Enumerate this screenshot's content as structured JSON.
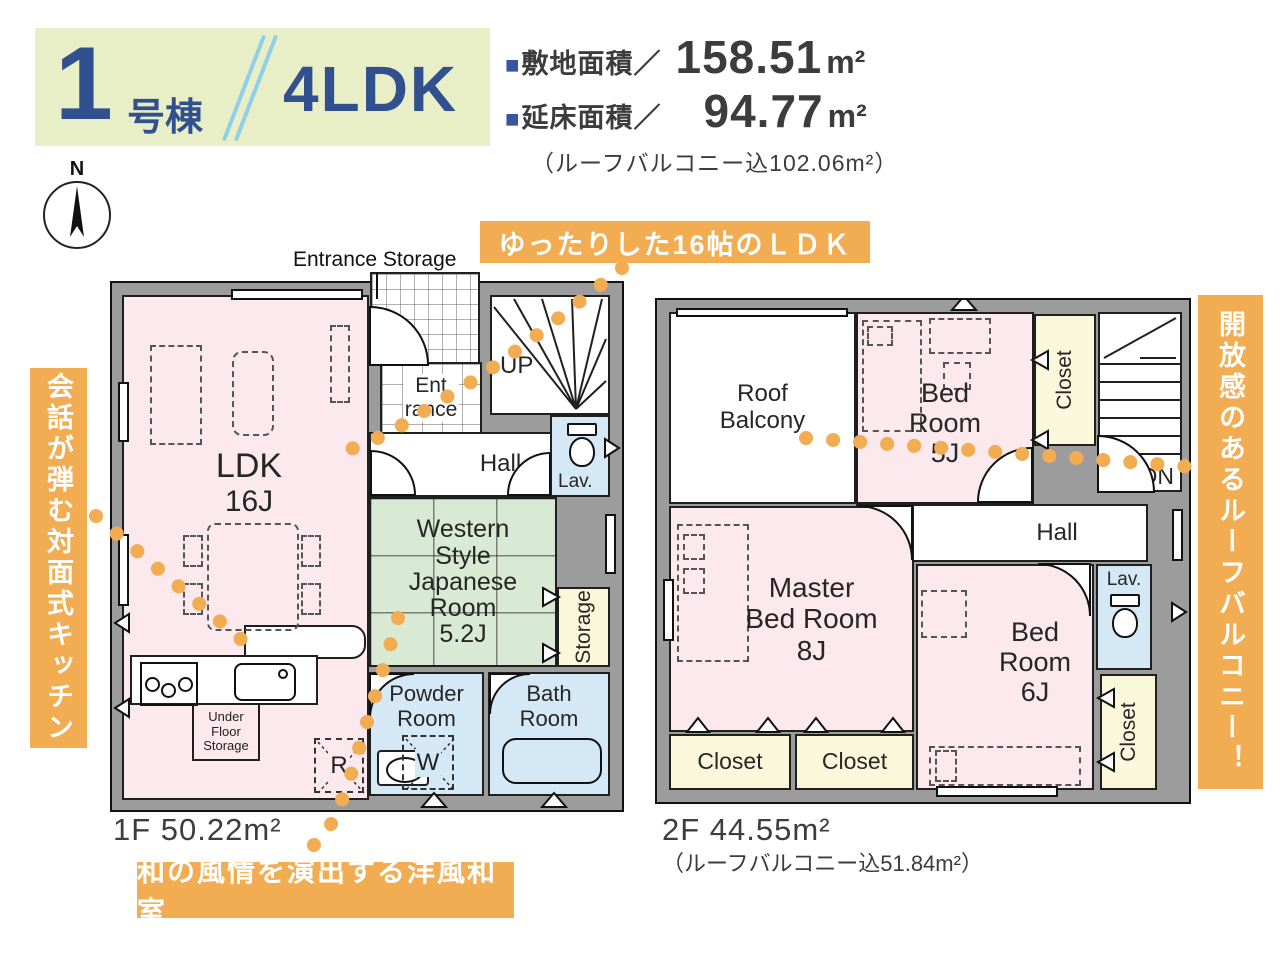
{
  "header": {
    "building_number": "1",
    "building_suffix": "号棟",
    "plan_type": "4LDK",
    "bullet": "■",
    "site_area_label": "敷地面積／",
    "site_area_value": "158.51",
    "floor_area_label": "延床面積／",
    "floor_area_value": "94.77",
    "area_unit": "m²",
    "balcony_note": "（ルーフバルコニー込102.06m²）"
  },
  "compass": {
    "north_label": "N"
  },
  "callouts": {
    "ldk": "ゆったりした16帖のＬＤＫ",
    "kitchen": "会話が弾む対面式キッチン",
    "roof_balcony": "開放感のあるルーフバルコニー！",
    "japanese_room": "和の風情を演出する洋風和室"
  },
  "floor1": {
    "caption": "1F 50.22m²",
    "entrance_storage_label": "Entrance Storage",
    "rooms": {
      "ldk": {
        "name": "LDK",
        "size": "16J"
      },
      "entrance": {
        "line1": "Ent",
        "line2": "rance"
      },
      "stairs": "UP",
      "hall": "Hall",
      "lavatory": "Lav.",
      "japanese_room": {
        "line1": "Western",
        "line2": "Style",
        "line3": "Japanese",
        "line4": "Room",
        "size": "5.2J"
      },
      "storage": "Storage",
      "powder_room": {
        "line1": "Powder",
        "line2": "Room"
      },
      "bath_room": {
        "line1": "Bath",
        "line2": "Room"
      },
      "under_floor_storage": {
        "line1": "Under",
        "line2": "Floor",
        "line3": "Storage"
      },
      "refrigerator": "R",
      "washer": "W"
    }
  },
  "floor2": {
    "caption": "2F 44.55m²",
    "balcony_note": "（ルーフバルコニー込51.84m²）",
    "rooms": {
      "roof_balcony": {
        "line1": "Roof",
        "line2": "Balcony"
      },
      "bedroom5": {
        "line1": "Bed",
        "line2": "Room",
        "size": "5J"
      },
      "closet_top": "Closet",
      "stairs": "DN",
      "hall": "Hall",
      "master_bedroom": {
        "line1": "Master",
        "line2": "Bed Room",
        "size": "8J"
      },
      "bedroom6": {
        "line1": "Bed",
        "line2": "Room",
        "size": "6J"
      },
      "lavatory": "Lav.",
      "closet_left": "Closet",
      "closet_mid": "Closet",
      "closet_right": "Closet"
    }
  },
  "colors": {
    "accent_orange": "#f2ad53",
    "title_blue": "#31508f",
    "slash_blue": "#8fd0e8",
    "badge_bg": "#e8eec6",
    "room_pink": "#fce9ee",
    "room_green": "#d8e9d4",
    "room_blue": "#d4e8f5",
    "room_yellow": "#fbf7da",
    "wall_gray": "#9c9c9c"
  }
}
